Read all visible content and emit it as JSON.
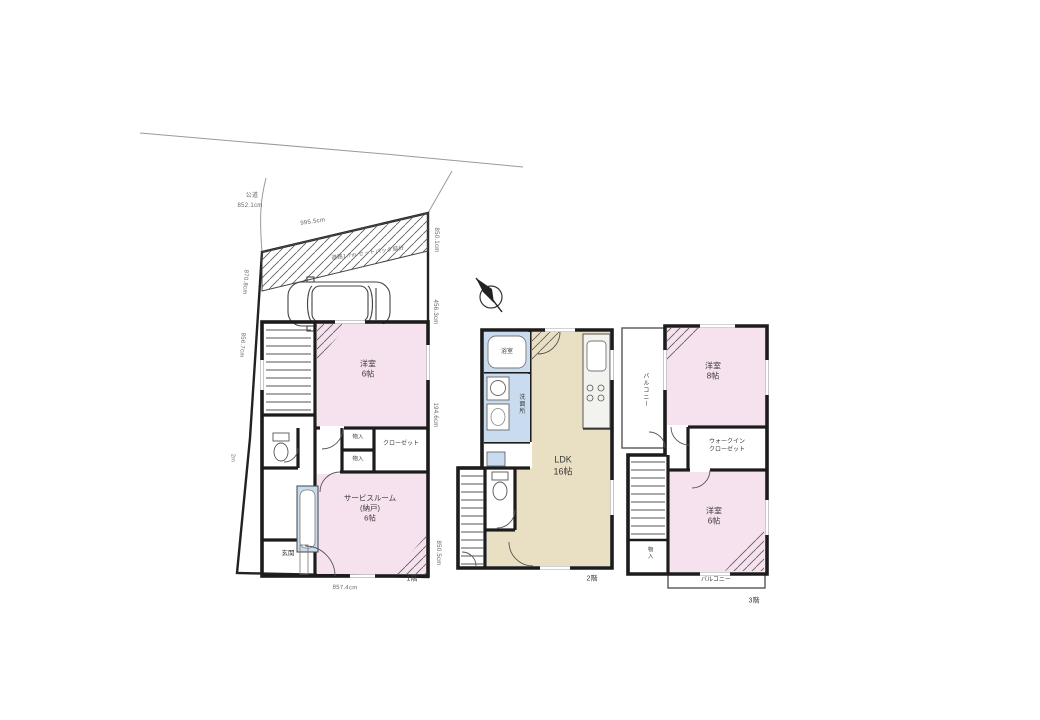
{
  "title": "3階建て住宅 間取り図",
  "colors": {
    "room_pink": "#f6e1ee",
    "ldk_tan": "#e9dfc3",
    "wet_blue": "#c9dcef",
    "wall": "#1c1c1c",
    "dim_text": "#666666"
  },
  "site": {
    "road": "公道",
    "road_width": "852.1cm",
    "setback": "道路1.7m セットバック部分",
    "dim_top": "995.5cm",
    "dim_right_top": "850.1cm",
    "dim_right_mid": "456.3cm",
    "dim_right_low": "194.6cm",
    "dim_right_bottom": "850.5cm",
    "dim_left_top": "870.8cm",
    "dim_left_mid": "856.7cm",
    "dim_left_low": "2m",
    "dim_bottom": "857.4cm"
  },
  "icons": {
    "north_arrow": "north-arrow",
    "car": "car-top-view",
    "bathtub": "bathtub",
    "toilet": "toilet",
    "stairs": "stairs"
  },
  "floors": {
    "f1": {
      "label": "1階",
      "bedroom": "洋室\n6帖",
      "service": "サービスルーム\n(納戸)\n6帖",
      "closet": "クローゼット",
      "storage_a": "物入",
      "storage_b": "物入",
      "entrance": "玄関"
    },
    "f2": {
      "label": "2階",
      "ldk": "LDK\n16帖",
      "bath": "浴室",
      "wash": "洗面所"
    },
    "f3": {
      "label": "3階",
      "bed_a": "洋室\n8帖",
      "bed_b": "洋室\n6帖",
      "wic": "ウォークイン\nクローゼット",
      "balcony_left": "バルコニー",
      "balcony_bottom": "バルコニー",
      "storage": "物入"
    }
  }
}
